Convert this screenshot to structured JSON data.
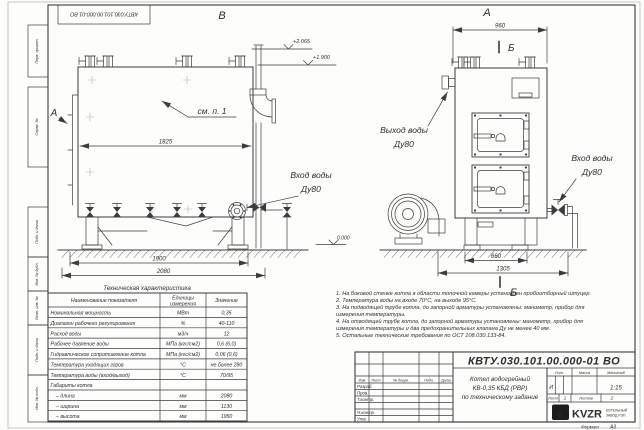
{
  "sheet": {
    "doc_number_stamp": "КВТУ.030.101.00.000-01 ВО",
    "format_label": "Формат",
    "format_value": "А3",
    "margin": {
      "perv_primen": "Перв. примен.",
      "sprav_no": "Справ. №",
      "podp_data_1": "Подп. и дата",
      "inv_no_dubl": "Инв. № дубл.",
      "vzam_inv_no": "Взам. инв. №",
      "podp_data_2": "Подп. и дата",
      "inv_no_podl": "Инв. № подл."
    }
  },
  "views": {
    "side": {
      "label": "В",
      "section_arrow_label": "А",
      "see_ref": "см. п. 1",
      "dim_body": "1825",
      "dim_supports": "1900",
      "dim_overall": "2080",
      "elev_stack": "+2.065",
      "elev_top": "+1.900",
      "elev_ground": "0.000",
      "inlet_label_1": "Вход воды",
      "inlet_label_2": "Ду80"
    },
    "front": {
      "label": "А",
      "dim_width": "960",
      "section_mark_top": "Б",
      "section_mark_bottom": "Б",
      "dim_base": "660",
      "dim_overall": "1305",
      "outlet_label_1": "Выход воды",
      "outlet_label_2": "Ду80",
      "inlet_label_1": "Вход воды",
      "inlet_label_2": "Ду80"
    }
  },
  "spec_table": {
    "title": "Техническая характеристика",
    "headers": {
      "name": "Наименование показателя",
      "units_1": "Единицы",
      "units_2": "измерения",
      "value": "Значение"
    },
    "rows": [
      {
        "name": "Номинальная мощность",
        "units": "МВт",
        "value": "0,35"
      },
      {
        "name": "Диапазон рабочего регулирования",
        "units": "%",
        "value": "40-110"
      },
      {
        "name": "Расход воды",
        "units": "м3/ч",
        "value": "12"
      },
      {
        "name": "Рабочее давление воды",
        "units": "МПа (кгс/см2)",
        "value": "0,6 (6,0)"
      },
      {
        "name": "Гидравлическое сопротивление котла",
        "units": "МПа (кгс/см2)",
        "value": "0,06 (0,6)"
      },
      {
        "name": "Температура уходящих газов",
        "units": "°С",
        "value": "не более 280"
      },
      {
        "name": "Температура воды (вход/выход)",
        "units": "°С",
        "value": "70/95"
      },
      {
        "name": "Габариты котла",
        "units": "",
        "value": ""
      },
      {
        "name": "– длина",
        "units": "мм",
        "value": "2080"
      },
      {
        "name": "– ширина",
        "units": "мм",
        "value": "1130"
      },
      {
        "name": "– высота",
        "units": "мм",
        "value": "1950"
      }
    ]
  },
  "notes": [
    "1. На боковой стенке котла в области топочной камеры установлен пробоотборный штуцер.",
    "2. Температура воды на входе 70°С, на выходе 95°С.",
    "3. На подводящей трубе котла, до запорной арматуры установлены: манометр, прибор для измерения температуры.",
    "4. На отводящей трубе котла, до запорной арматуры установлены: манометр, прибор для измерения температуры и два предохранительных клапана Ду не менее 40 мм.",
    "5. Остальные технические требования по ОСТ 108.030.133-84."
  ],
  "title_block": {
    "doc_number": "КВТУ.030.101.00.000-01 ВО",
    "cols": {
      "izm": "Изм",
      "list": "Лист",
      "doc": "№ докум.",
      "podp": "Подп.",
      "data": "Дата"
    },
    "staff": [
      "Разраб.",
      "Пров.",
      "Т.контр.",
      "Н.контр.",
      "Утв."
    ],
    "product_line_1": "Котел водогрейный",
    "product_line_2": "КВ-0,35 КБД (РВР)",
    "product_line_3": "по техническому задание",
    "lit_label": "Лит.",
    "lit_value": "И",
    "mass_label": "Масса",
    "scale_label": "Масштаб",
    "scale_value": "1:15",
    "sheet_label": "Лист",
    "sheet_value": "1",
    "sheets_label": "Листов",
    "sheets_value": "2",
    "logo_mark": "КЗР",
    "logo_text": "KVZR",
    "company_line_1": "КОТЕЛЬНЫЙ",
    "company_line_2": "ЗАВОД РЭП"
  }
}
